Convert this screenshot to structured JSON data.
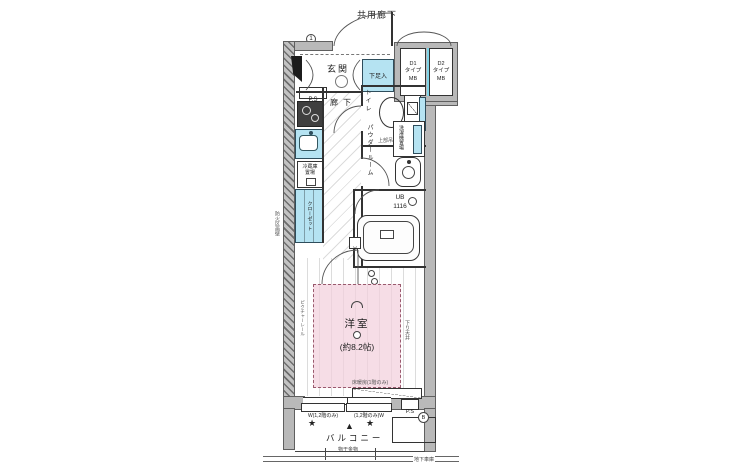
{
  "colors": {
    "wall_gray": "#b9b9b9",
    "fixture_blue": "#b5e3f2",
    "room_pink": "#f3d0dd",
    "mb_divider_cyan": "#7fd4e8"
  },
  "plan": {
    "corridor": "共用廊下",
    "wall_marker": "1",
    "mb": {
      "d1": [
        "D1",
        "タイプ",
        "MB"
      ],
      "d2": [
        "D2",
        "タイプ",
        "MB"
      ]
    },
    "genkan": "玄関",
    "shoe_cabinet": "下足入",
    "pipe_space_top": "P.S",
    "kitchen": {
      "fridge_line1": "冷蔵庫",
      "fridge_line2": "置場",
      "closet": "クローゼット"
    },
    "hallway": "廊下",
    "toilet": "トイレ",
    "upper_cabinet": "上部吊戸棚",
    "powder_room": "パウダールーム",
    "laundry": "洗濯機置場",
    "bath": {
      "line1": "UB",
      "line2": "1116",
      "y_marker": "Y"
    },
    "room": {
      "name": "洋室",
      "size": "(約8.2帖)",
      "floor_heating": "床暖房(1階のみ)"
    },
    "notes": {
      "picture_rail": "ピクチャーレール",
      "lowered_ceiling": "下り天井",
      "firewall": "防火区画壁",
      "basement": "地下車庫"
    },
    "windows": {
      "left": "W(1,2階のみ)",
      "right": "(1,2階のみ)W"
    },
    "balcony": {
      "name": "バルコニー",
      "drying": "物干金物",
      "hatch_marker": "B",
      "pipe_space": "P.S"
    },
    "markers": {
      "star": "★",
      "triangle": "▲"
    }
  }
}
